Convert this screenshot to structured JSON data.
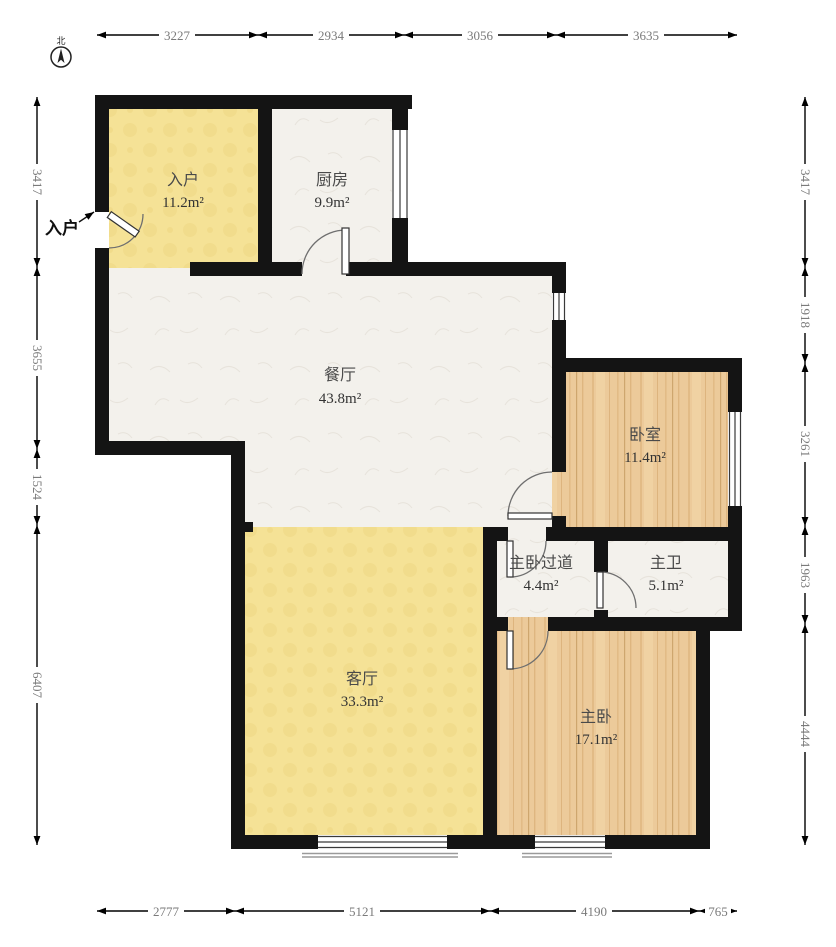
{
  "compass": {
    "north_label": "北"
  },
  "entry_marker": {
    "label": "入户"
  },
  "rooms": [
    {
      "id": "entry-hall",
      "name": "入户",
      "area": "11.2m²"
    },
    {
      "id": "kitchen",
      "name": "厨房",
      "area": "9.9m²"
    },
    {
      "id": "dining-room",
      "name": "餐厅",
      "area": "43.8m²"
    },
    {
      "id": "bedroom",
      "name": "卧室",
      "area": "11.4m²"
    },
    {
      "id": "master-corridor",
      "name": "主卧过道",
      "area": "4.4m²"
    },
    {
      "id": "master-bath",
      "name": "主卫",
      "area": "5.1m²"
    },
    {
      "id": "living-room",
      "name": "客厅",
      "area": "33.3m²"
    },
    {
      "id": "master-bedroom",
      "name": "主卧",
      "area": "17.1m²"
    }
  ],
  "dimensions": {
    "top": [
      "3227",
      "2934",
      "3056",
      "3635"
    ],
    "bottom": [
      "2777",
      "5121",
      "4190",
      "765"
    ],
    "left": [
      "3417",
      "3655",
      "1524",
      "6407"
    ],
    "right": [
      "3417",
      "1918",
      "3261",
      "1963",
      "4444"
    ]
  },
  "colors": {
    "wall": "#141414",
    "dim_line": "#000000",
    "dim_text": "#7a7a7a",
    "label_name": "#4a4a4a",
    "label_area": "#333333",
    "yellow_base": "#f5e296",
    "yellow_motif": "#ecd27c",
    "paper_base": "#f3f1ec",
    "wood_base": "#ecca9a",
    "wood_grain": "#d8ab72"
  }
}
